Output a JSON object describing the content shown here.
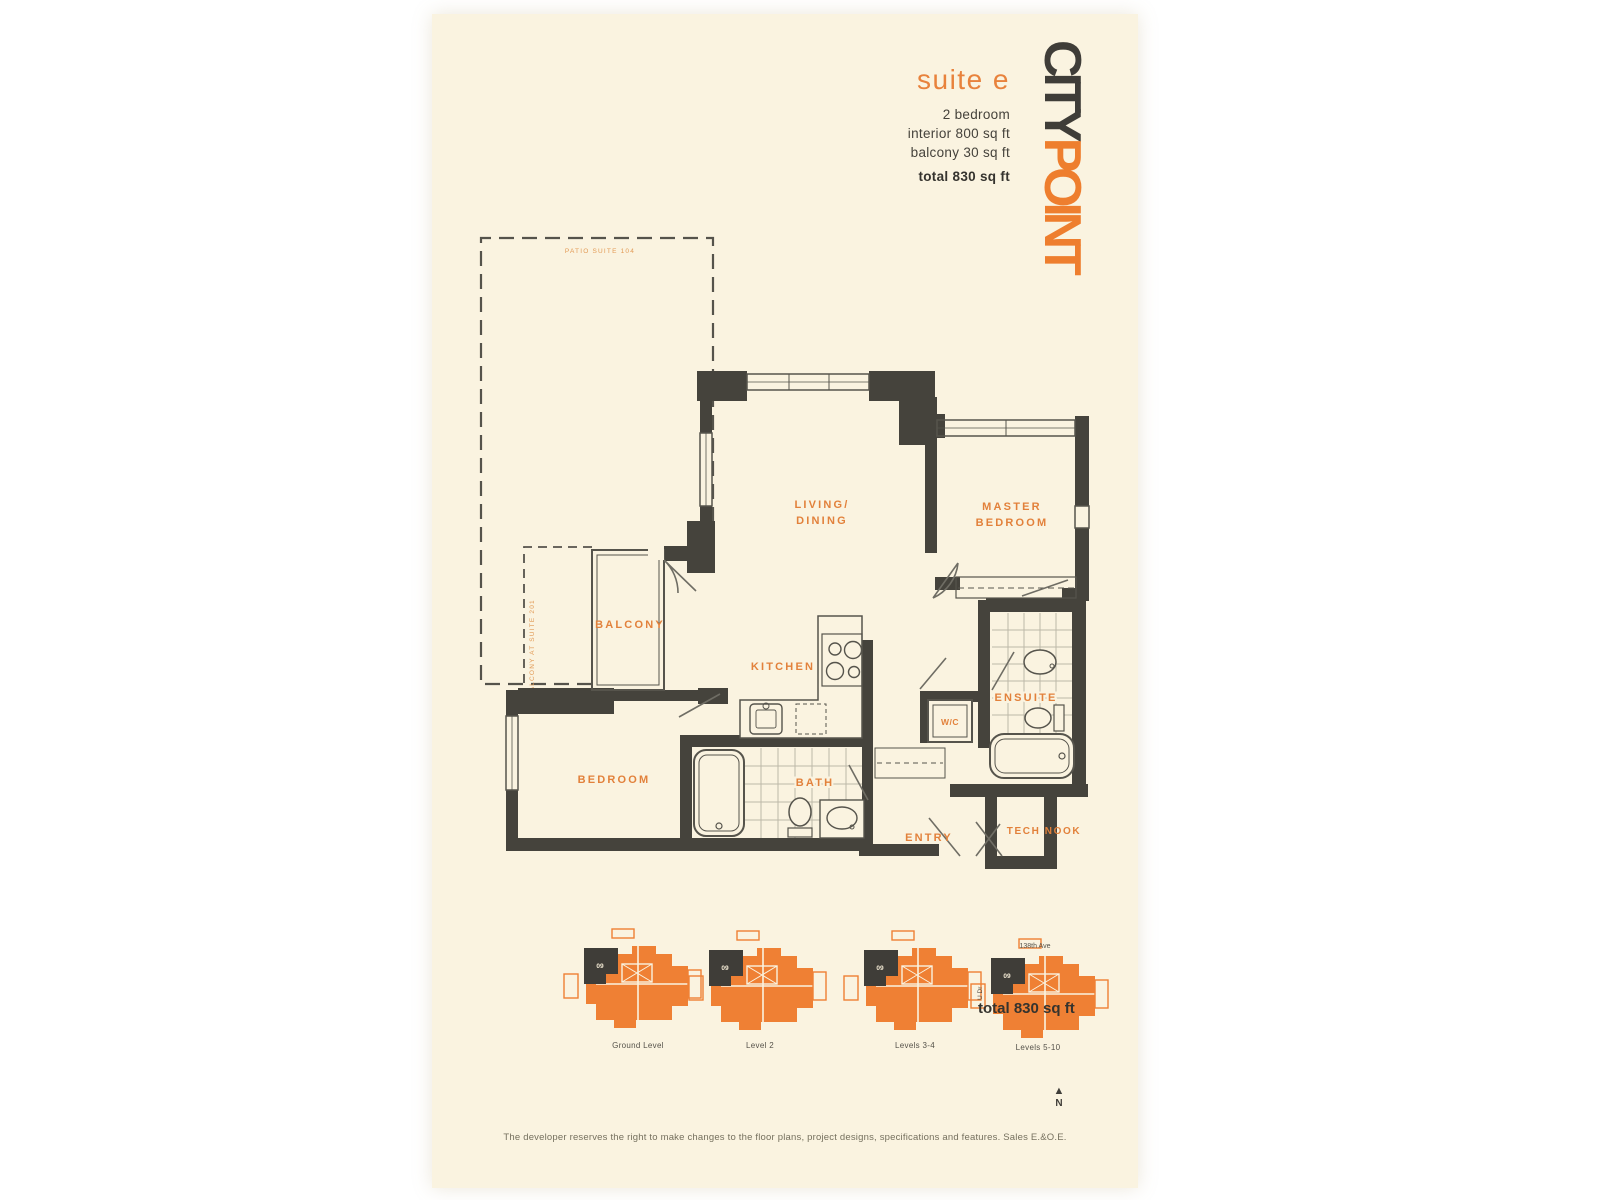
{
  "header": {
    "suite_label": "suite e",
    "spec_lines": [
      "2 bedroom",
      "interior 800 sq ft",
      "balcony   30 sq ft"
    ],
    "total": "total 830 sq ft"
  },
  "logo": {
    "part1": "CITY",
    "part2": "POINT"
  },
  "floor_plan": {
    "labels": {
      "living1": "LIVING/",
      "living2": "DINING",
      "master1": "MASTER",
      "master2": "BEDROOM",
      "balcony": "BALCONY",
      "kitchen": "KITCHEN",
      "bedroom": "BEDROOM",
      "bath": "BATH",
      "ensuite": "ENSUITE",
      "wc": "W/C",
      "entry": "ENTRY",
      "tech_nook": "TECH NOOK",
      "patio_note": "PATIO SUITE 104",
      "balcony_note": "BALCONY AT SUITE 201"
    }
  },
  "levels": [
    {
      "caption": "Ground Level",
      "unit": "09"
    },
    {
      "caption": "Level 2",
      "unit": "09"
    },
    {
      "caption": "Levels 3-4",
      "unit": "09"
    },
    {
      "caption": "Levels 5-10",
      "unit": "09",
      "street_top": "138th Ave",
      "street_left": "U Dr",
      "overlay": "total 830 sq ft"
    }
  ],
  "compass": {
    "arrow": "▲",
    "label": "N"
  },
  "footer": {
    "disclaimer": "The developer reserves the right to make changes to the floor plans, project designs, specifications and features. Sales E.&O.E."
  },
  "colors": {
    "accent_orange": "#ee7e2e",
    "label_orange": "#e2813b",
    "wall_dark": "#45433c",
    "page_cream": "#faf3e0",
    "logo_dark": "#3f3d38"
  }
}
